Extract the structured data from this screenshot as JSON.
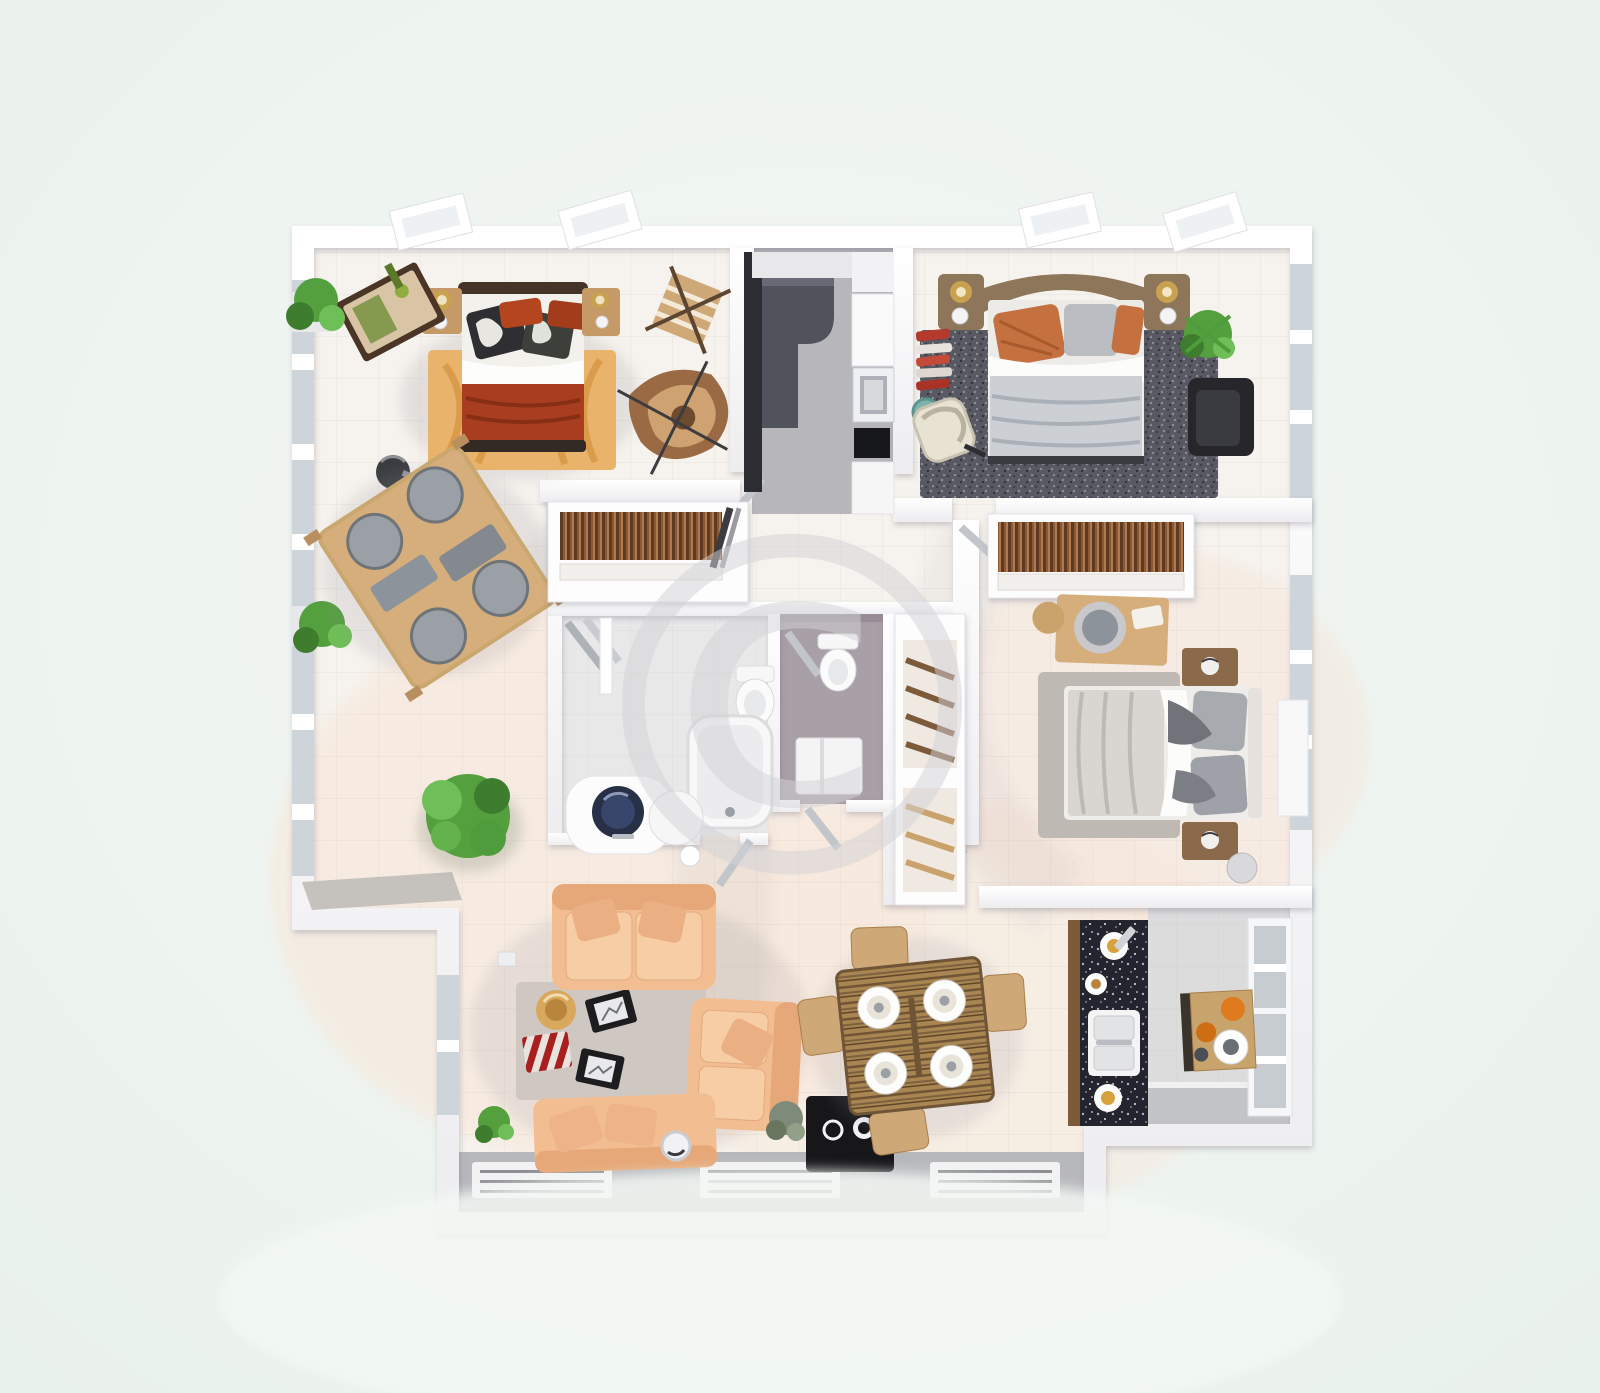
{
  "title": "3D top-view apartment floor plan render",
  "watermark": {
    "symbol": "©"
  },
  "colors": {
    "background": "#edf3ef",
    "floor_base": "#f6f2ed",
    "floor_warm": "#f8e7d9",
    "floor_gray": "#dcdcdd",
    "wall_white": "#ffffff",
    "glass": "#cdd5da",
    "terrace_gray": "#b7b8bc",
    "bench_gray": "#c5c1bc",
    "rug_orange": "#e9b36b",
    "bed1_blanket_red": "#a93d1f",
    "bed1_headboard": "#46332a",
    "pillow_red": "#b4451f",
    "pillow_damask_dark": "#2f2f33",
    "wood_tan": "#d5ae7c",
    "wood_mid": "#b98f5f",
    "wood_dark": "#7c5a3a",
    "chair_seat_gray": "#9aa0a6",
    "table_panel_gray": "#8d939a",
    "stool_black": "#3a3c40",
    "plant_green": "#55a03e",
    "plant_green_dark": "#3f7d2e",
    "kitchen_counter_dark": "#50525c",
    "kitchen_cabinet_black": "#2c2d33",
    "cooktop_black": "#17181c",
    "rug2_shag_dark": "#585963",
    "bed2_blanket_gray": "#ccd0d5",
    "bed2_pillow_orange": "#c4713f",
    "bed2_headboard_brown": "#8d765a",
    "lamp_gold": "#c8a24e",
    "armchair_black": "#26262b",
    "clothes_red": "#b43a2e",
    "wc_mauve_floor": "#a99fa7",
    "fixture_white": "#fbfbfb",
    "basin_navy": "#273046",
    "sofa_peach": "#f3bd92",
    "sofa_peach_dark": "#e6a878",
    "rug_living_gray": "#cfc8c2",
    "mat_red": "#a81f1f",
    "hat_tan": "#d8a95c",
    "frame_black": "#1d1d20",
    "tv_black": "#17171a",
    "granite_black": "#23242e",
    "sink_white": "#f4f4f4",
    "fruit_orange": "#e07a1f",
    "bed3_blanket": "#d9d6d1",
    "bed3_pillow_gray": "#a7aaaf",
    "rug3_gray": "#beb9b3",
    "watermark_gray": "#d3d3d7"
  },
  "scene": {
    "type": "floor_plan_3d_top_view",
    "rooms": [
      {
        "name": "bedroom-top-left",
        "furniture": [
          "double-bed-red-bedding",
          "orange-patterned-rug",
          "nightstand-left",
          "nightstand-right",
          "dressing-trolley",
          "folding-chair",
          "lounge-chair",
          "window-plants",
          "black-stool"
        ]
      },
      {
        "name": "dining-nook-left",
        "furniture": [
          "square-wood-table",
          "four-gray-seat-chairs",
          "potted-tree"
        ]
      },
      {
        "name": "galley-kitchen-top",
        "furniture": [
          "tall-black-cabinet",
          "dark-l-counter",
          "oven",
          "black-cooktop",
          "white-cabinets"
        ]
      },
      {
        "name": "bedroom-top-right",
        "furniture": [
          "double-bed-gray-bedding",
          "brown-headboard-with-lamps",
          "dark-shag-rug",
          "black-armchair",
          "plant",
          "clothes-rack",
          "cream-chair",
          "teal-side-table"
        ]
      },
      {
        "name": "wardrobe-closet",
        "furniture": [
          "hanging-clothes-rail",
          "shelf",
          "leaning-boards"
        ]
      },
      {
        "name": "bathroom",
        "furniture": [
          "bathtub",
          "toilet",
          "vanity-navy-basin",
          "round-side-table",
          "shower-rails",
          "door-leaf"
        ]
      },
      {
        "name": "wc",
        "furniture": [
          "toilet",
          "sink-cabinet",
          "towel-rail",
          "door-leaf"
        ]
      },
      {
        "name": "hall-closet",
        "furniture": [
          "slanted-shelf-unit"
        ]
      },
      {
        "name": "bedroom-right",
        "furniture": [
          "double-bed",
          "wardrobe-rail",
          "dressing-desk-round-mirror",
          "stool",
          "nightstand-top",
          "nightstand-bottom",
          "gray-rug",
          "side-cabinet",
          "waste-bin"
        ]
      },
      {
        "name": "living-room",
        "furniture": [
          "sofa-top",
          "sofa-right",
          "sofa-bottom",
          "gray-rug",
          "red-striped-mat",
          "sun-hat",
          "black-frame-1",
          "black-frame-2",
          "robot-vacuum",
          "plants",
          "tv-console"
        ]
      },
      {
        "name": "dining-area",
        "furniture": [
          "wood-dining-table",
          "four-place-settings",
          "four-wood-chairs"
        ]
      },
      {
        "name": "kitchen-counter-run",
        "furniture": [
          "granite-counter",
          "double-sink",
          "plates"
        ]
      },
      {
        "name": "breakfast-room",
        "furniture": [
          "wood-table",
          "oranges",
          "ring-plate",
          "window-wall"
        ]
      }
    ]
  }
}
